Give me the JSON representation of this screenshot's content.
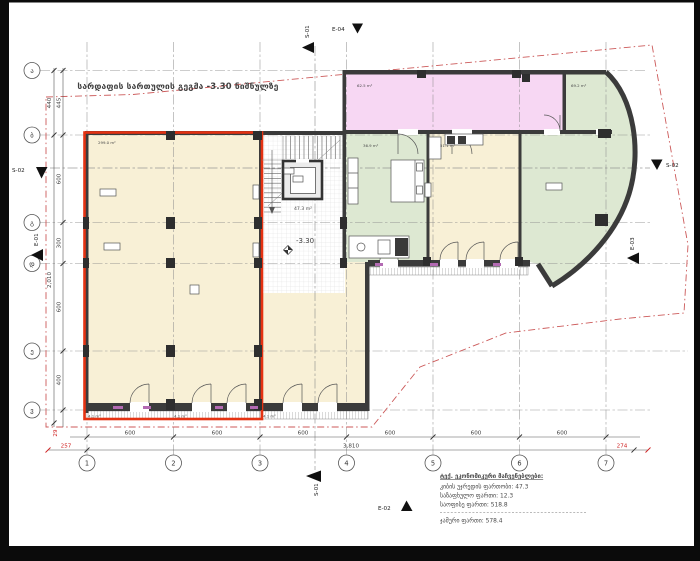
{
  "title": "სარდაფის სართულის გეგმა -3.30 ნიშნულზე",
  "level_mark": "-3.30",
  "rooms": {
    "commercial_area": "299.0 m²",
    "stair_area": "47.3 m²",
    "pink_area": "62.5 m²",
    "green_right_area": "69.2 m²",
    "bedroom_area": "36.9 m²",
    "living_area": "51.1 m²",
    "entry_area": "4.1 m²"
  },
  "grid": {
    "cols": [
      "1",
      "2",
      "3",
      "4",
      "5",
      "6",
      "7"
    ],
    "rows": [
      "ა",
      "ბ",
      "გ",
      "დ",
      "ე",
      "ვ"
    ]
  },
  "dims": {
    "bottom": [
      "600",
      "600",
      "600",
      "600",
      "600",
      "600"
    ],
    "bottom_overall": "3,810",
    "red_left": "257",
    "red_right": "274",
    "red_small": "29",
    "left_outer": [
      "440",
      "2,010"
    ],
    "left_inner": [
      "445",
      "600",
      "300",
      "600",
      "400"
    ]
  },
  "markers": {
    "s01": "S-01",
    "s02": "S-02",
    "e01": "E-01",
    "e02": "E-02",
    "e03": "E-03",
    "e04": "E-04"
  },
  "summary": {
    "heading": "ტექ. ეკონომიკური მაჩვენებლები:",
    "line1": "კიბის უჯრედის ფართობი: 47.3",
    "line2": "საზაფხულო ფართი: 12.3",
    "line3": "საოფისე ფართი: 518.8",
    "total": "ჯამური ფართი: 578.4"
  },
  "colors": {
    "highlight_red": "#e53212",
    "cream": "#f8f0d6",
    "pink": "#f7d7f3",
    "green": "#dde8d2",
    "wall": "#3b3b3b",
    "parcel_red": "#cc5a5a"
  }
}
